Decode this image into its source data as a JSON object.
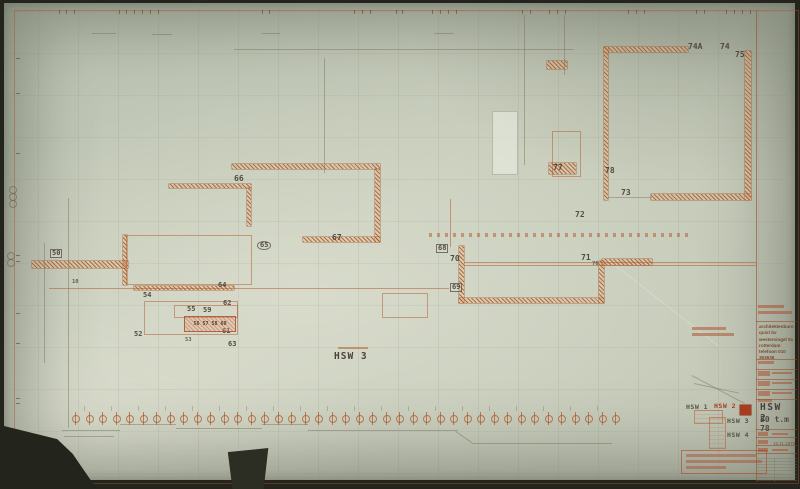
{
  "title_block": {
    "architect_lines": [
      "architektenburo",
      "quist bv",
      "westersingel 51",
      "rotterdam",
      "telefoon 010 363636"
    ],
    "drawing_code": "HSW 2",
    "drawing_range": "50 t.m 78",
    "date_note": "15.11.1975"
  },
  "legend": {
    "hsw1": "HSW 1",
    "hsw2": "HSW 2",
    "hsw3": "HSW 3",
    "hsw4": "HSW 4"
  },
  "plan": {
    "big_label": "HSW 3",
    "pink_box_text": "56 57 58 60",
    "labels": [
      {
        "t": "50",
        "x": 46,
        "y": 246,
        "s": "boxed"
      },
      {
        "t": "10",
        "x": 68,
        "y": 277,
        "s": "tiny"
      },
      {
        "t": "52",
        "x": 130,
        "y": 328
      },
      {
        "t": "54",
        "x": 139,
        "y": 289
      },
      {
        "t": "53",
        "x": 181,
        "y": 335,
        "s": "tiny"
      },
      {
        "t": "55",
        "x": 183,
        "y": 303
      },
      {
        "t": "59",
        "x": 199,
        "y": 304
      },
      {
        "t": "61",
        "x": 218,
        "y": 325
      },
      {
        "t": "62",
        "x": 219,
        "y": 297
      },
      {
        "t": "63",
        "x": 224,
        "y": 338
      },
      {
        "t": "64",
        "x": 214,
        "y": 279
      },
      {
        "t": "65",
        "x": 253,
        "y": 238,
        "s": "circled"
      },
      {
        "t": "66",
        "x": 230,
        "y": 172,
        "s": "big"
      },
      {
        "t": "67",
        "x": 328,
        "y": 231,
        "s": "big"
      },
      {
        "t": "68",
        "x": 432,
        "y": 241,
        "s": "boxed"
      },
      {
        "t": "69",
        "x": 446,
        "y": 280,
        "s": "boxed"
      },
      {
        "t": "70",
        "x": 446,
        "y": 252,
        "s": "big"
      },
      {
        "t": "71",
        "x": 577,
        "y": 251,
        "s": "big"
      },
      {
        "t": "76",
        "x": 588,
        "y": 259,
        "s": "tiny"
      },
      {
        "t": "72",
        "x": 571,
        "y": 208,
        "s": "big"
      },
      {
        "t": "73",
        "x": 617,
        "y": 186,
        "s": "big"
      },
      {
        "t": "74A",
        "x": 684,
        "y": 40,
        "s": "big"
      },
      {
        "t": "74",
        "x": 716,
        "y": 40,
        "s": "big"
      },
      {
        "t": "75",
        "x": 731,
        "y": 48,
        "s": "big"
      },
      {
        "t": "77",
        "x": 549,
        "y": 161,
        "s": "big"
      },
      {
        "t": "78",
        "x": 601,
        "y": 164,
        "s": "big"
      }
    ]
  },
  "colors": {
    "ink_orange": "#b05a26",
    "paper": "#c6cbba",
    "text_dark": "#4a4138",
    "legend_fill_red": "#a83c20",
    "backdrop": "#23241c"
  }
}
